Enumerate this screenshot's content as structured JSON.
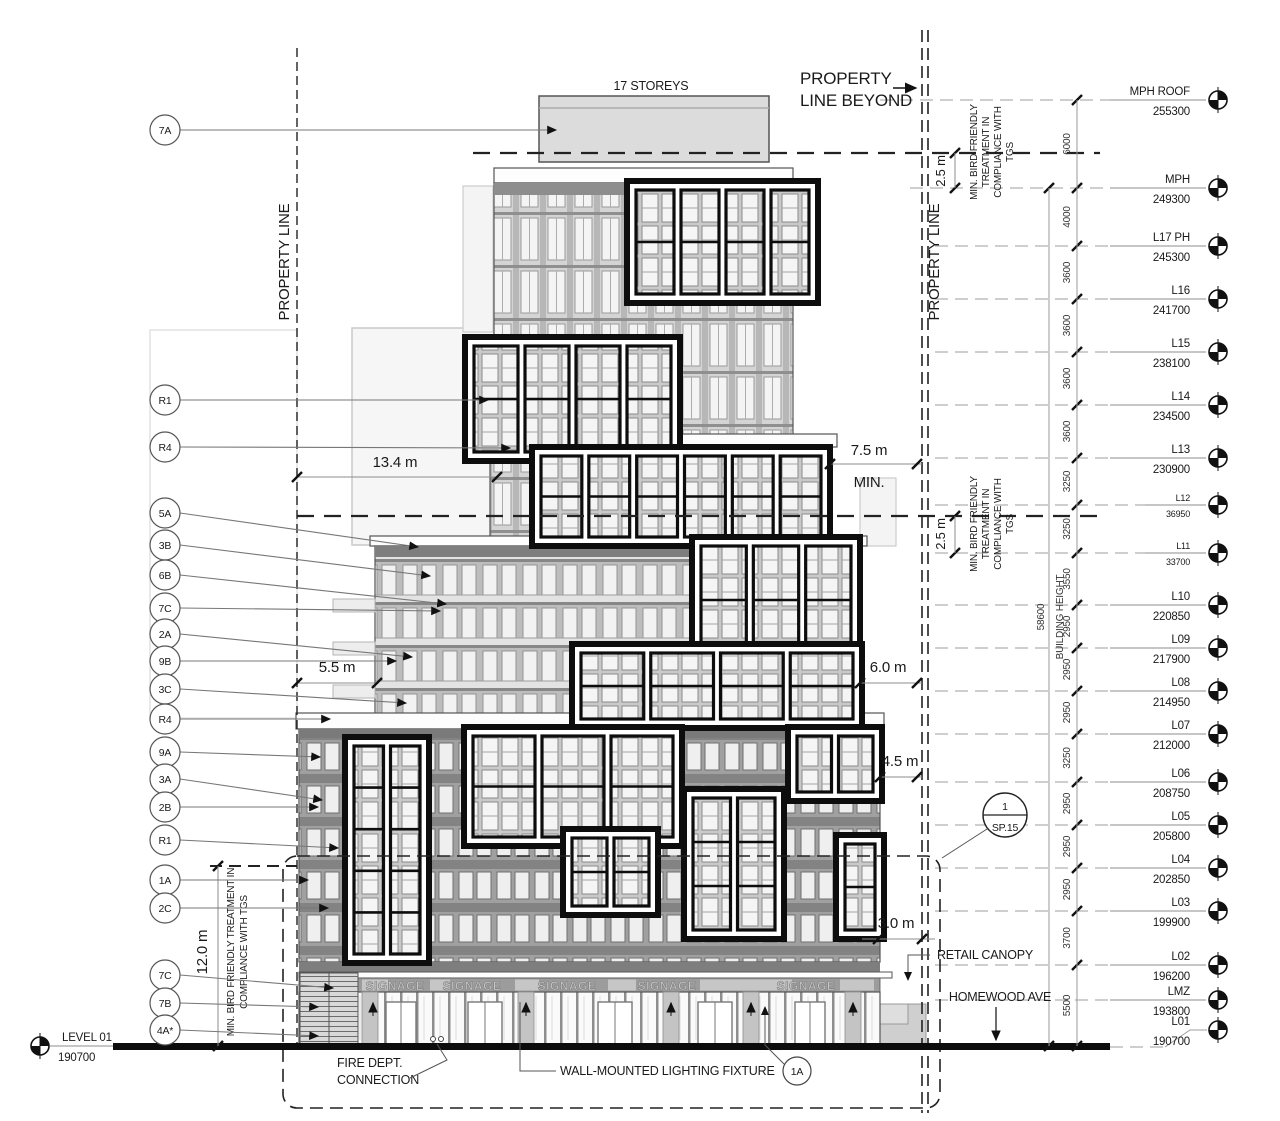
{
  "title_block": {
    "storeys_label": "17 STOREYS",
    "property_line_beyond": [
      "PROPERTY",
      "LINE BEYOND"
    ],
    "property_line_left": "PROPERTY LINE",
    "property_line_right": "PROPERTY LINE"
  },
  "levels": [
    {
      "name": "MPH ROOF",
      "elevation": "255300"
    },
    {
      "name": "MPH",
      "elevation": "249300"
    },
    {
      "name": "L17 PH",
      "elevation": "245300"
    },
    {
      "name": "L16",
      "elevation": "241700"
    },
    {
      "name": "L15",
      "elevation": "238100"
    },
    {
      "name": "L14",
      "elevation": "234500"
    },
    {
      "name": "L13",
      "elevation": "230900"
    },
    {
      "name": "L12",
      "elevation": "36950",
      "small": true
    },
    {
      "name": "L11",
      "elevation": "33700",
      "small": true
    },
    {
      "name": "L10",
      "elevation": "220850"
    },
    {
      "name": "L09",
      "elevation": "217900"
    },
    {
      "name": "L08",
      "elevation": "214950"
    },
    {
      "name": "L07",
      "elevation": "212000"
    },
    {
      "name": "L06",
      "elevation": "208750"
    },
    {
      "name": "L05",
      "elevation": "205800"
    },
    {
      "name": "L04",
      "elevation": "202850"
    },
    {
      "name": "L03",
      "elevation": "199900"
    },
    {
      "name": "L02",
      "elevation": "196200"
    },
    {
      "name": "LMZ",
      "elevation": "193800"
    },
    {
      "name": "L01",
      "elevation": "190700"
    }
  ],
  "floor_dims": [
    "6000",
    "4000",
    "3600",
    "3600",
    "3600",
    "3600",
    "3250",
    "3250",
    "3550",
    "2950",
    "2950",
    "2950",
    "3250",
    "2950",
    "2950",
    "2950",
    "3700",
    "5500"
  ],
  "building_height": {
    "value": "58600",
    "label": "BUILDING HEIGHT"
  },
  "dimensions": {
    "d134": "13.4 m",
    "d75": "7.5 m",
    "d75_min": "MIN.",
    "d55": "5.5 m",
    "d60": "6.0 m",
    "d45": "4.5 m",
    "d30": "3.0 m",
    "d120": "12.0 m",
    "d25_top": "2.5 m",
    "d25_mid": "2.5 m"
  },
  "bird_note": {
    "lines": [
      "MIN. BIRD FRIENDLY",
      "TREATMENT IN",
      "COMPLIANCE WITH",
      "TGS"
    ],
    "left_lines": [
      "MIN. BIRD FRIENDLY TREATMENT IN",
      "COMPLIANCE WITH TGS"
    ]
  },
  "callouts": [
    "7A",
    "R1",
    "R4",
    "5A",
    "3B",
    "6B",
    "7C",
    "2A",
    "9B",
    "3C",
    "R4",
    "9A",
    "3A",
    "2B",
    "R1",
    "1A",
    "2C",
    "7C",
    "7B",
    "4A*"
  ],
  "level01_marker": {
    "name": "LEVEL 01",
    "elevation": "190700"
  },
  "section_ref": {
    "top": "1",
    "bottom": "SP.15"
  },
  "notes": {
    "retail_canopy": "RETAIL CANOPY",
    "street": "HOMEWOOD AVE",
    "fire_dept": [
      "FIRE DEPT.",
      "CONNECTION"
    ],
    "wall_light": "WALL-MOUNTED LIGHTING FIXTURE",
    "bottom_callout": "1A"
  },
  "signage": {
    "label": "SIGNAGE",
    "count": 5
  }
}
